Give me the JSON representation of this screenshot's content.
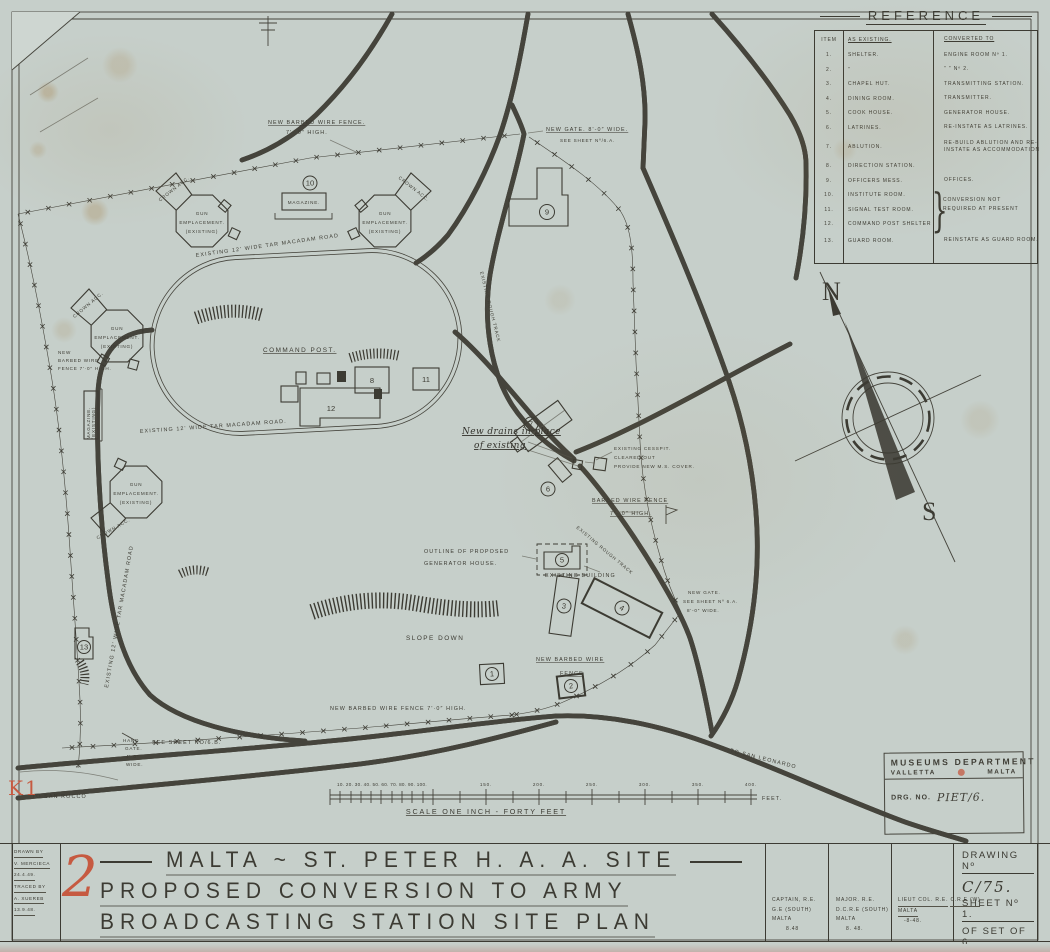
{
  "reference_table": {
    "title": "REFERENCE",
    "col_item": "ITEM",
    "col_existing": "AS EXISTING.",
    "col_converted": "CONVERTED TO",
    "rows": [
      {
        "no": "1.",
        "existing": "SHELTER.",
        "converted": "ENGINE ROOM Nº 1."
      },
      {
        "no": "2.",
        "existing": "”",
        "converted": "”   ”   Nº 2."
      },
      {
        "no": "3.",
        "existing": "CHAPEL HUT.",
        "converted": "TRANSMITTING STATION."
      },
      {
        "no": "4.",
        "existing": "DINING ROOM.",
        "converted": "TRANSMITTER."
      },
      {
        "no": "5.",
        "existing": "COOK HOUSE.",
        "converted": "GENERATOR HOUSE."
      },
      {
        "no": "6.",
        "existing": "LATRINES.",
        "converted": "RE-INSTATE AS LATRINES."
      },
      {
        "no": "7.",
        "existing": "ABLUTION.",
        "converted": "RE-BUILD ABLUTION AND RE-INSTATE AS ACCOMMODATION"
      },
      {
        "no": "8.",
        "existing": "DIRECTION STATION.",
        "converted": ""
      },
      {
        "no": "9.",
        "existing": "OFFICERS MESS.",
        "converted": "OFFICES."
      },
      {
        "no": "10.",
        "existing": "INSTITUTE ROOM.",
        "converted": ""
      },
      {
        "no": "11.",
        "existing": "SIGNAL TEST ROOM.",
        "converted": ""
      },
      {
        "no": "12.",
        "existing": "COMMAND POST SHELTER",
        "converted": ""
      },
      {
        "no": "13.",
        "existing": "GUARD ROOM.",
        "converted": "REINSTATE AS GUARD ROOM."
      }
    ],
    "bracket_glyph": "}",
    "bracket_note": "CONVERSION NOT REQUIRED AT PRESENT"
  },
  "map_labels": {
    "fence_top_l1": "NEW BARBED WIRE FENCE.",
    "fence_top_l2": "7'· 0″ HIGH.",
    "gate_top_l1": "NEW GATE. 8'-0″ WIDE.",
    "gate_top_l2": "SEE SHEET Nº/6.A.",
    "crown_acc": "CROWN ACC.",
    "gun_l1": "GUN",
    "gun_l2": "EMPLACEMENT.",
    "gun_l3": "(EXISTING)",
    "magazine": "MAGAZINE.",
    "magazine_left_l1": "MAGAZINE.",
    "magazine_left_l2": "(EXISTING)",
    "fence_left_l1": "NEW",
    "fence_left_l2": "BARBED WIRE",
    "fence_left_l3": "FENCE 7'·0″ HIGH.",
    "road_oval_top": "EXISTING 12' WIDE TAR MACADAM ROAD",
    "road_oval_bottom": "EXISTING 12' WIDE TAR MACADAM ROAD.",
    "road_left": "EXISTING 12' WIDE TAR MACADAM ROAD",
    "command_post": "COMMAND POST.",
    "track_ne": "EXISTING ROUGH TRACK",
    "track_se": "EXISTING ROUGH TRACK",
    "drains_l1": "New drains in place",
    "drains_l2": "of existing",
    "cesspit_l1": "EXISTING CESSPIT.",
    "cesspit_l2": "CLEARED OUT",
    "cesspit_l3": "PROVIDE NEW M.S. COVER.",
    "fence_mid_l1": "BARBED WIRE FENCE",
    "fence_mid_l2": "7'· 0″ HIGH.",
    "generator_l1": "OUTLINE OF PROPOSED",
    "generator_l2": "GENERATOR HOUSE.",
    "existing_building": "EXISTING BUILDING",
    "slope_down": "SLOPE DOWN",
    "fence_new_l1": "NEW BARBED WIRE",
    "fence_new_l2": "FENCE",
    "gate_6a_l1": "NEW GATE.",
    "gate_6a_l2": "SEE SHEET Nº 6.A.",
    "gate_6a_l3": "8'-0″ WIDE.",
    "fence_bottom": "NEW BARBED WIRE FENCE 7'·0″ HIGH.",
    "hand_gate_l1": "HAND",
    "hand_gate_l2": "GATE.",
    "hand_gate_l3": "4'·0″",
    "hand_gate_l4": "WIDE.",
    "see_sheet_6b": "SEE SHEET NO/6.B.",
    "to_san_rocco": "TO SAN ROCCO",
    "to_san_leonardo": "TO SAN LEONARDO"
  },
  "buildings": {
    "b1": "1",
    "b2": "2",
    "b3": "3",
    "b4": "4",
    "b5": "5",
    "b6": "6",
    "b7": "7",
    "b8": "8",
    "b9": "9",
    "b10": "10",
    "b11": "11",
    "b12": "12",
    "b13": "13"
  },
  "compass": {
    "north": "N",
    "south": "S"
  },
  "scale_bar": {
    "cluster": "10. 20. 30. 40. 50. 60. 70. 80. 90. 100.",
    "t150": "150.",
    "t200": "200.",
    "t250": "250.",
    "t300": "300.",
    "t350": "350.",
    "t400": "400.",
    "feet": "FEET.",
    "label": "SCALE ONE INCH - FORTY FEET"
  },
  "stamp": {
    "dept": "MUSEUMS DEPARTMENT",
    "city": "VALLETTA",
    "island": "MALTA",
    "drg_label": "DRG. NO.",
    "drg_no": "PIET/6."
  },
  "title_block": {
    "drawn_by_label": "DRAWN BY",
    "drawn_by": "V. MERCIECA",
    "drawn_date": "24.4.49.",
    "traced_by_label": "TRACED BY",
    "traced_by": "A. XUEREB",
    "traced_date": "13.9.48.",
    "title_l1": "MALTA ~ ST. PETER H. A. A. SITE",
    "title_l2": "PROPOSED CONVERSION TO ARMY",
    "title_l3": "BROADCASTING STATION SITE PLAN",
    "sig1_l1": "CAPTAIN, R.E.",
    "sig1_l2": "G.E (SOUTH)",
    "sig1_l3": "MALTA",
    "sig1_l4": "8.48",
    "sig2_l1": "MAJOR. R.E.",
    "sig2_l2": "D.C.R.E (SOUTH)",
    "sig2_l3": "MALTA",
    "sig2_l4": "8. 48.",
    "sig3_l1": "LIEUT COL. R.E.",
    "sig3_l2": "C.R.E (W)",
    "sig3_l3": "MALTA",
    "sig3_l4": "-8-48.",
    "drawing_no_label": "DRAWING Nº",
    "drawing_no": "C/75.",
    "sheet_no": "SHEET Nº 1.",
    "of_set": "OF SET OF 6"
  },
  "marks": {
    "k1": "K1",
    "red_no": "2"
  }
}
